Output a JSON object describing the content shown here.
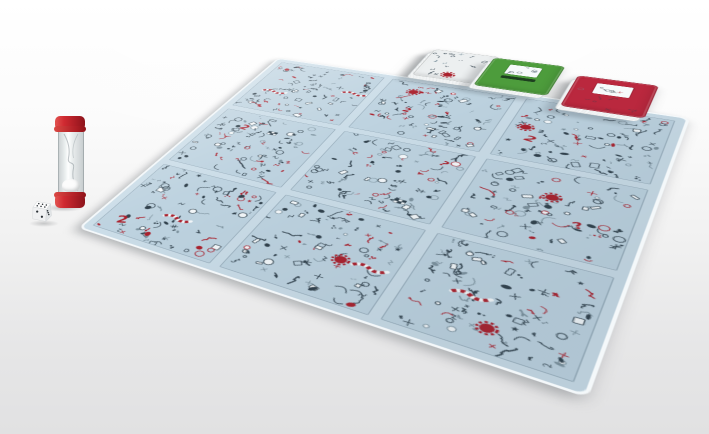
{
  "scene": {
    "objects": [
      "doodle seek-and-find game board",
      "sand timer",
      "white die",
      "white card deck",
      "green card deck",
      "red card deck"
    ]
  },
  "background": {
    "top_color": "#ffffff",
    "bottom_color": "#e1e1e2"
  },
  "board": {
    "base_color": "#cbdde8",
    "edge_color": "#f4f8fa",
    "panel_color": "#bed3e0",
    "rows": 3,
    "cols": 3,
    "doodles": {
      "palette": {
        "dark": "#31414c",
        "mid": "#7e939f",
        "red": "#ab212d",
        "light": "#e9f0f5",
        "white": "#f4f8fa"
      },
      "items_per_panel": 92,
      "features_per_panel": 2,
      "red_ratio": 0.17,
      "glyphs": [
        "2",
        "?",
        "!",
        "★",
        "♪",
        "3"
      ],
      "seed": 11
    }
  },
  "timer": {
    "cap_color": "#c9242c",
    "sand_color": "#fcfcfc"
  },
  "die": {
    "body_color": "#fbfbfb",
    "pip_color": "#2b3136",
    "faces": {
      "top": 6,
      "front": 2,
      "right": 3
    }
  },
  "decks": [
    {
      "name": "white",
      "card_color": "#eceff0",
      "art_marks": 16
    },
    {
      "name": "green",
      "card_color": "#4d9c3c",
      "band_color": "#1d3f1f",
      "square_marks": 7
    },
    {
      "name": "red",
      "card_color": "#b8293e",
      "art_marks": 14,
      "square_marks": 7
    }
  ]
}
